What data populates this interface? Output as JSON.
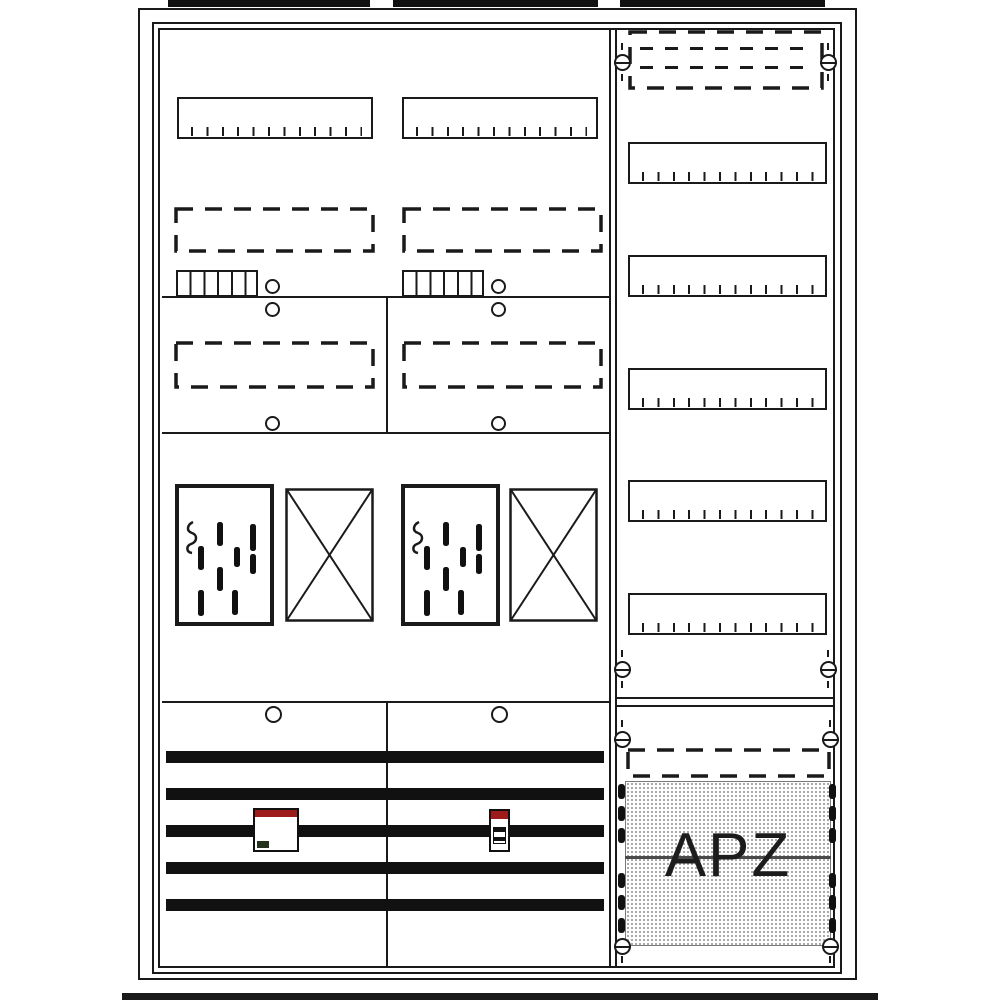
{
  "diagram": {
    "apz": {
      "label": "APZ"
    },
    "colors": {
      "outline": "#1a1a1a",
      "busbar": "#111111",
      "device_red": "#9e1b1b",
      "device_label_green": "#24321e",
      "stipple_dot": "#999999",
      "apz_text": "#1c1c1c"
    },
    "icons": {
      "meter_plate": "meter-contact-plate-icon",
      "reserve_field": "crossed-reserve-field-icon",
      "screw": "slotted-screw-icon",
      "knockout": "knockout-hole-icon"
    }
  }
}
